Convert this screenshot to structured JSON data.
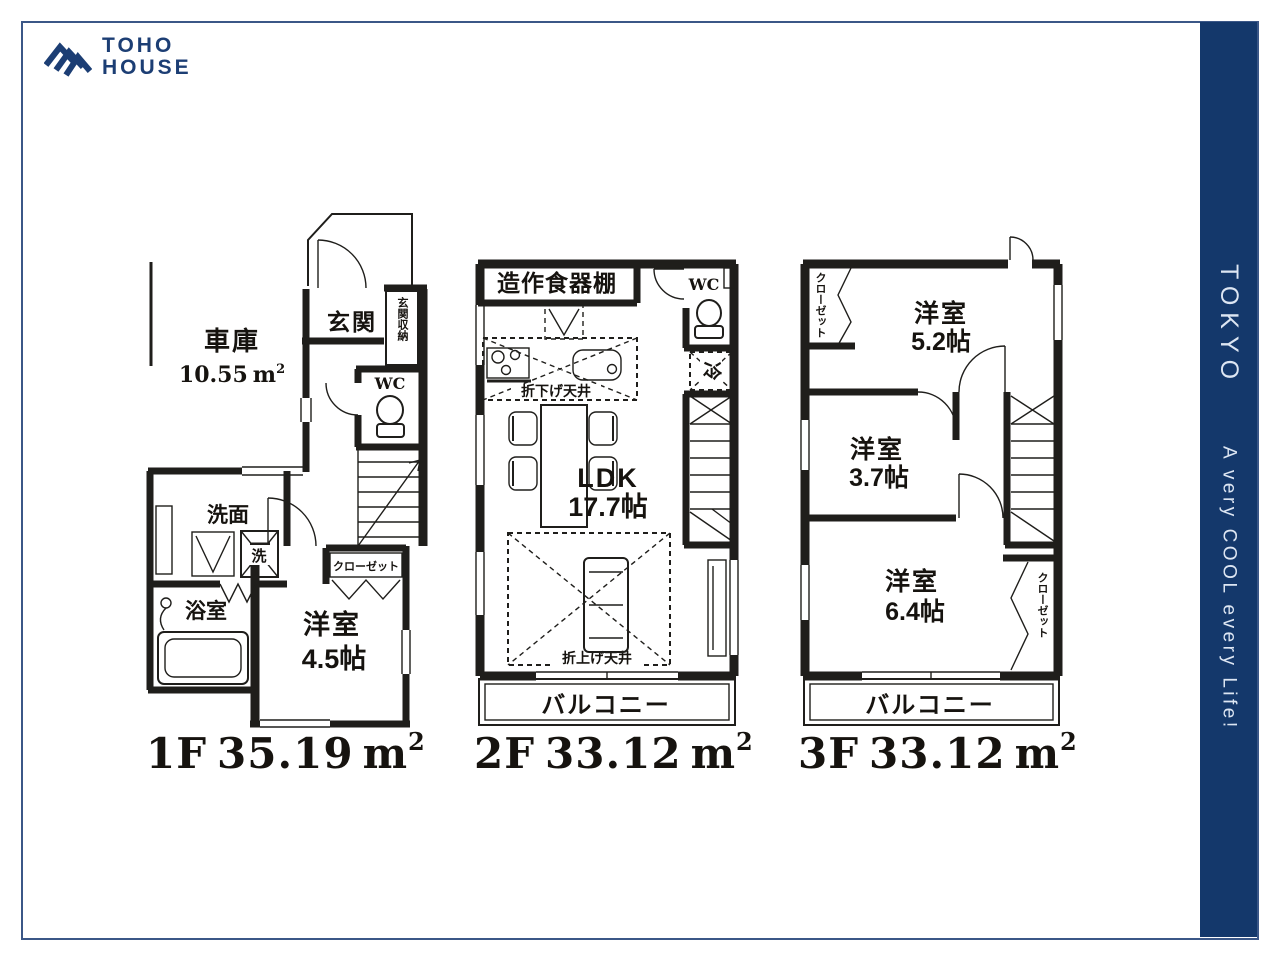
{
  "brand": {
    "line1": "TOHO",
    "line2": "HOUSE"
  },
  "sidebar": {
    "city": "TOKYO",
    "tagline": "A very COOL every Life!"
  },
  "floors": [
    {
      "floor": "1F",
      "area": "35.19",
      "area_unit": "m",
      "area_sup": "2",
      "rooms": {
        "garage": "車庫",
        "garage_area": "10.55",
        "garage_unit": "m",
        "garage_sup": "2",
        "entrance": "玄関",
        "entrance_storage": "玄関収納",
        "wc": "WC",
        "washroom": "洗面",
        "washer": "洗",
        "bathroom": "浴室",
        "western": "洋室",
        "western_size": "4.5帖",
        "closet": "クローゼット"
      }
    },
    {
      "floor": "2F",
      "area": "33.12",
      "area_unit": "m",
      "area_sup": "2",
      "rooms": {
        "cupboard": "造作食器棚",
        "wc": "WC",
        "fridge": "冷",
        "ldk": "LDK",
        "ldk_size": "17.7帖",
        "lowered_ceiling": "折下げ天井",
        "raised_ceiling": "折上げ天井",
        "balcony": "バルコニー"
      }
    },
    {
      "floor": "3F",
      "area": "33.12",
      "area_unit": "m",
      "area_sup": "2",
      "rooms": {
        "closet_top": "クローゼット",
        "room52": "洋室",
        "room52_size": "5.2帖",
        "room37": "洋室",
        "room37_size": "3.7帖",
        "room64": "洋室",
        "room64_size": "6.4帖",
        "closet_bottom": "クローゼット",
        "balcony": "バルコニー"
      }
    }
  ]
}
